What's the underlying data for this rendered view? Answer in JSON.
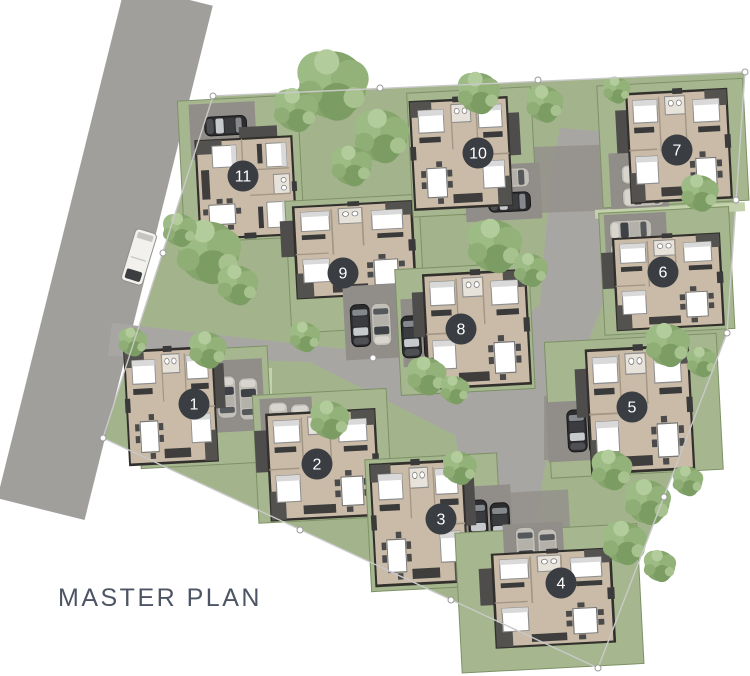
{
  "title": "MASTER PLAN",
  "lots": [
    {
      "number": "1"
    },
    {
      "number": "2"
    },
    {
      "number": "3"
    },
    {
      "number": "4"
    },
    {
      "number": "5"
    },
    {
      "number": "6"
    },
    {
      "number": "7"
    },
    {
      "number": "8"
    },
    {
      "number": "9"
    },
    {
      "number": "10"
    },
    {
      "number": "11"
    }
  ],
  "colors": {
    "background": "#ffffff",
    "site_green": "#a3b48c",
    "lawn": "#a6b78f",
    "walkway_green": "#c3d2aa",
    "road_main": "#a19f9c",
    "road_internal": "#a8a6a3",
    "paver": "#918e8a",
    "house_floor": "#c9bba7",
    "house_outline": "#32302c",
    "roof_dark": "#53524f",
    "tree_green": "#86a56d",
    "badge_bg": "#3a3d42",
    "badge_text": "#ffffff",
    "boundary_line": "#c9c9c9",
    "title_text": "#4d5565"
  }
}
